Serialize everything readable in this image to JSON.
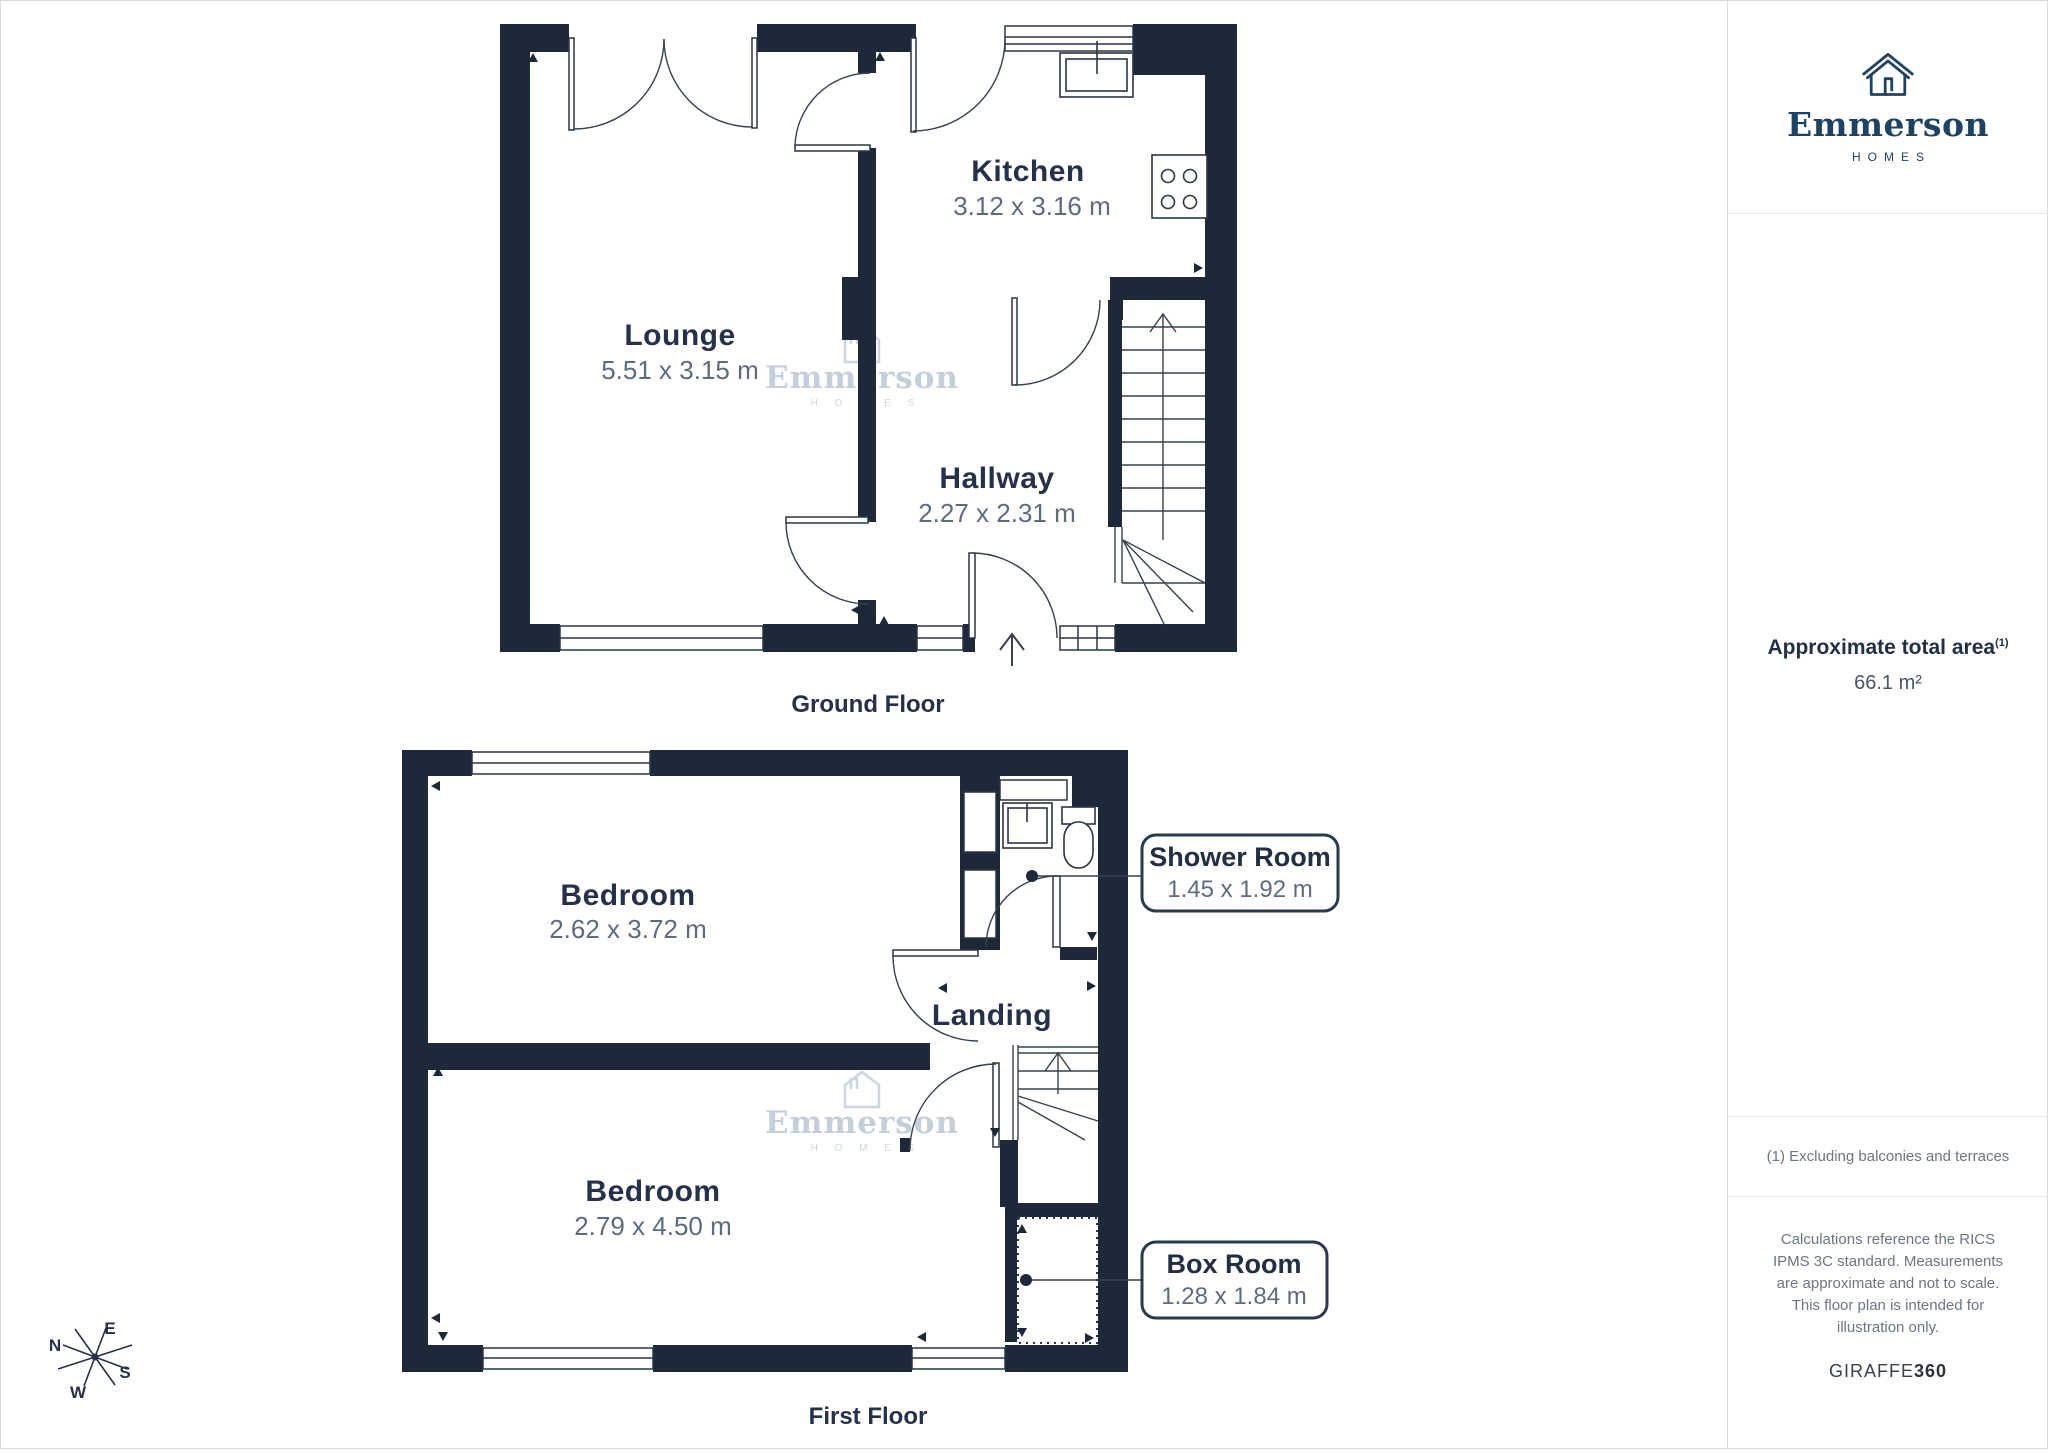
{
  "floors": {
    "ground": {
      "title": "Ground Floor",
      "rooms": [
        {
          "name": "Lounge",
          "dims": "5.51 x 3.15 m"
        },
        {
          "name": "Kitchen",
          "dims": "3.12 x 3.16 m"
        },
        {
          "name": "Hallway",
          "dims": "2.27 x 2.31 m"
        }
      ]
    },
    "first": {
      "title": "First Floor",
      "rooms": [
        {
          "name": "Bedroom",
          "dims": "2.62 x 3.72 m"
        },
        {
          "name": "Bedroom",
          "dims": "2.79 x 4.50 m"
        },
        {
          "name": "Landing",
          "dims": ""
        }
      ],
      "callouts": [
        {
          "name": "Shower Room",
          "dims": "1.45 x 1.92 m"
        },
        {
          "name": "Box Room",
          "dims": "1.28 x 1.84 m"
        }
      ]
    }
  },
  "sidebar": {
    "brand": {
      "name": "Emmerson",
      "tagline": "HOMES"
    },
    "area_label": "Approximate total area",
    "area_superscript": "(1)",
    "area_value": "66.1 m²",
    "footnote": "(1) Excluding balconies and terraces",
    "disclaimer": "Calculations reference the RICS IPMS 3C standard. Measurements are approximate and not to scale. This floor plan is intended for illustration only.",
    "brand_footer_regular": "GIRAFFE",
    "brand_footer_bold": "360"
  },
  "compass": {
    "n": "N",
    "e": "E",
    "s": "S",
    "w": "W"
  },
  "watermark": {
    "name": "Emmerson",
    "tagline": "H O M E S"
  },
  "colors": {
    "wall": "#1d2838",
    "thin_line": "#2b3545",
    "room_label": "#25314a",
    "dims_text": "#5d6b80",
    "watermark": "#b9c7d4",
    "brand_navy": "#1e4264",
    "muted_text": "#6b7684",
    "divider": "#e4e6e9"
  }
}
